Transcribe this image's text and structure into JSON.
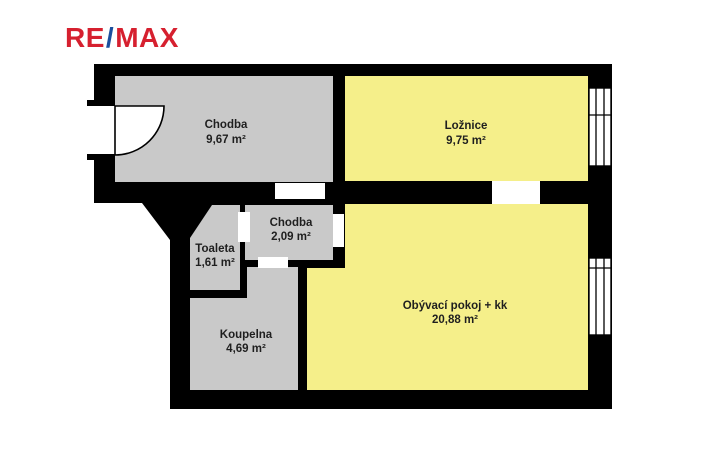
{
  "logo": {
    "re": "RE",
    "slash": "/",
    "max": "MAX"
  },
  "colors": {
    "logo_red": "#d6202f",
    "logo_blue": "#1b4f9e",
    "wall": "#000000",
    "room_gray": "#c9c9c9",
    "room_yellow": "#f5ef8a",
    "label_text": "#1f1f1f",
    "background": "#ffffff"
  },
  "rooms": [
    {
      "id": "chodba-entry",
      "name": "Chodba",
      "area": "9,67 m²"
    },
    {
      "id": "loznice",
      "name": "Ložnice",
      "area": "9,75 m²"
    },
    {
      "id": "chodba-inner",
      "name": "Chodba",
      "area": "2,09 m²"
    },
    {
      "id": "toaleta",
      "name": "Toaleta",
      "area": "1,61 m²"
    },
    {
      "id": "koupelna",
      "name": "Koupelna",
      "area": "4,69 m²"
    },
    {
      "id": "obyvaci-pokoj",
      "name": "Obývací pokoj + kk",
      "area": "20,88 m²"
    }
  ]
}
